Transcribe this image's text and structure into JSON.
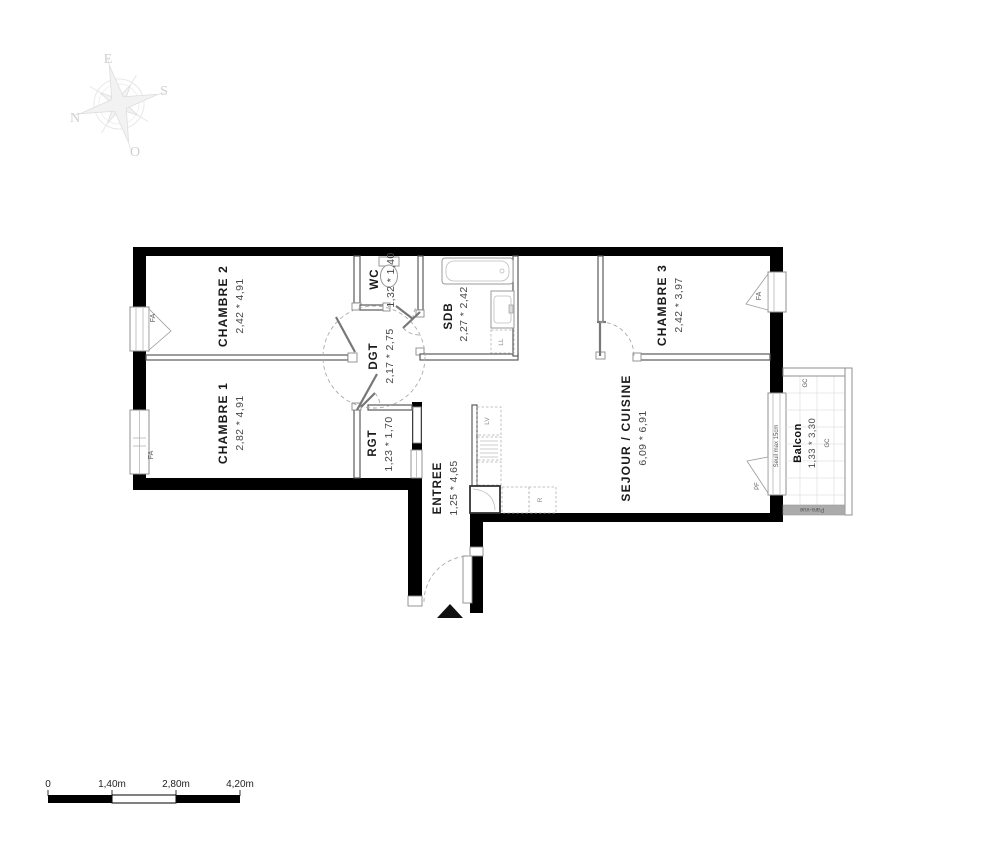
{
  "compass": {
    "e": "E",
    "s": "S",
    "n": "N",
    "o": "O"
  },
  "rooms": {
    "chambre2": {
      "name": "CHAMBRE 2",
      "dims": "2,42 * 4,91"
    },
    "chambre1": {
      "name": "CHAMBRE 1",
      "dims": "2,82 * 4,91"
    },
    "wc": {
      "name": "WC",
      "dims": "1,32 * 1,40"
    },
    "dgt": {
      "name": "DGT",
      "dims": "2,17 * 2,75"
    },
    "sdb": {
      "name": "SDB",
      "dims": "2,27 * 2,42"
    },
    "rgt": {
      "name": "RGT",
      "dims": "1,23 * 1,70"
    },
    "entree": {
      "name": "ENTREE",
      "dims": "1,25 * 4,65"
    },
    "sejour": {
      "name": "SEJOUR / CUISINE",
      "dims": "6,09 * 6,91"
    },
    "chambre3": {
      "name": "CHAMBRE 3",
      "dims": "2,42 * 3,97"
    },
    "balcon": {
      "name": "Balcon",
      "dims": "1,33 * 3,30"
    }
  },
  "annotations": {
    "window": "FA",
    "french_window": "PF",
    "gc": "GC",
    "washing_machine": "LL",
    "dishwasher": "LV",
    "fridge": "R",
    "threshold": "Seuil max 15cm",
    "privacy_screen": "Pare-vue"
  },
  "scale_bar": {
    "ticks": [
      "0",
      "1,40m",
      "2,80m",
      "4,20m"
    ]
  },
  "colors": {
    "wall": "#000000",
    "thin_wall": "#5a5a5a",
    "fixture": "#9a9a9a",
    "room_name": "#1a1a1a",
    "dims": "#474747",
    "small_label": "#555555",
    "compass": "#cfcfcf",
    "pare_vue": "#aaaaaa"
  }
}
